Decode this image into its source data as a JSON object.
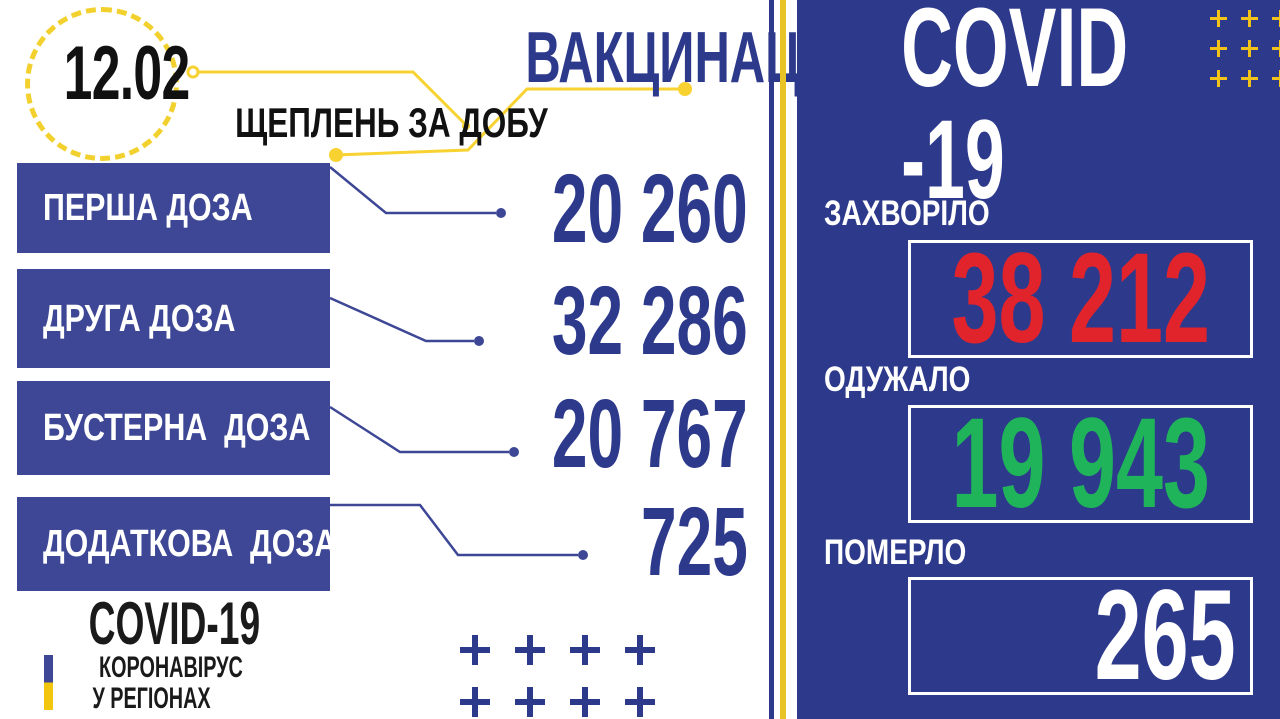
{
  "date_badge": {
    "date": "12.02"
  },
  "vaccination": {
    "title": "ВАКЦИНАЦІЯ",
    "subtitle": "ЩЕПЛЕНЬ ЗА ДОБУ",
    "doses": [
      {
        "label": "ПЕРША ДОЗА",
        "value": "20 260"
      },
      {
        "label": "ДРУГА ДОЗА",
        "value": "32 286"
      },
      {
        "label": "БУСТЕРНА  ДОЗА",
        "value": "20 767"
      },
      {
        "label": "ДОДАТКОВА  ДОЗА",
        "value": "725"
      }
    ]
  },
  "logo": {
    "title": "COVID-19",
    "subtitle_line1": "КОРОНАВІРУС",
    "subtitle_line2": "У РЕГІОНАХ"
  },
  "covid_panel": {
    "title": "COVID -19",
    "stats": [
      {
        "label": "ЗАХВОРІЛО",
        "value": "38 212",
        "value_color": "#e1232b"
      },
      {
        "label": "ОДУЖАЛО",
        "value": "19 943",
        "value_color": "#1fb45a"
      },
      {
        "label": "ПОМЕРЛО",
        "value": "265",
        "value_color": "#ffffff"
      }
    ]
  },
  "colors": {
    "navy_text": "#2d3a8c",
    "bar_blue": "#3d4795",
    "panel_blue": "#2d3a8c",
    "accent_yellow": "#f2d12e",
    "divider_yellow": "#e9c427",
    "flag_yellow": "#f2c50f",
    "sick_red": "#e1232b",
    "recovered_green": "#1fb45a",
    "white": "#ffffff",
    "black": "#111111"
  },
  "chart_data": [
    {
      "type": "table",
      "title": "ВАКЦИНАЦІЯ — ЩЕПЛЕНЬ ЗА ДОБУ (12.02)",
      "categories": [
        "ПЕРША ДОЗА",
        "ДРУГА ДОЗА",
        "БУСТЕРНА ДОЗА",
        "ДОДАТКОВА ДОЗА"
      ],
      "values": [
        20260,
        32286,
        20767,
        725
      ]
    },
    {
      "type": "table",
      "title": "COVID-19 (12.02)",
      "categories": [
        "ЗАХВОРІЛО",
        "ОДУЖАЛО",
        "ПОМЕРЛО"
      ],
      "values": [
        38212,
        19943,
        265
      ]
    }
  ]
}
